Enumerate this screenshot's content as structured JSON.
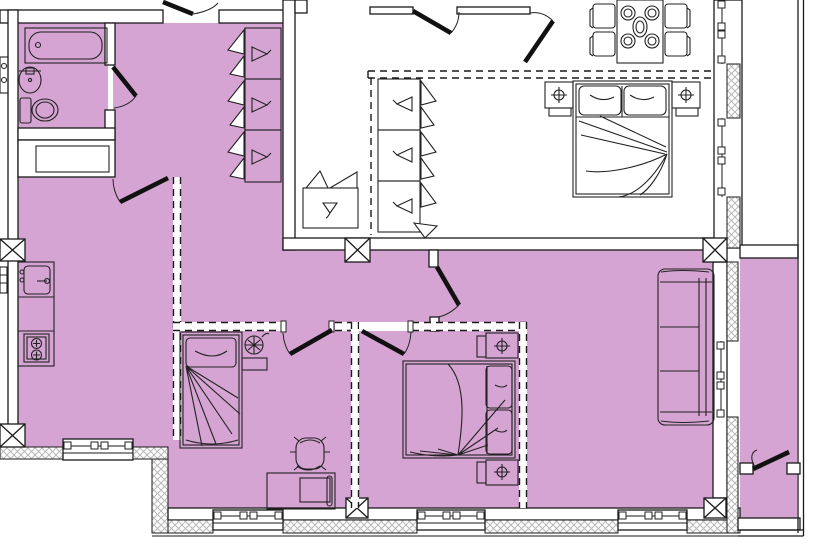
{
  "title": "apartment-floor-plan-with-highlighted-unit",
  "colors": {
    "floor_highlight": "#d5a4d3",
    "wall": "#ffffff",
    "line": "#1a1a1a",
    "hatch": "#b8b8b8",
    "door": "#111111"
  },
  "rooms": [
    {
      "name": "bathroom",
      "highlighted": true
    },
    {
      "name": "entry-hall",
      "highlighted": true
    },
    {
      "name": "kitchen-living-room",
      "highlighted": true
    },
    {
      "name": "bedroom-left",
      "highlighted": true
    },
    {
      "name": "bedroom-middle",
      "highlighted": true
    },
    {
      "name": "walk-through-closet",
      "highlighted": false
    },
    {
      "name": "bedroom-top-right",
      "highlighted": false
    },
    {
      "name": "loggia-top-right",
      "highlighted": false
    },
    {
      "name": "balcony-right",
      "highlighted": true
    }
  ],
  "furniture": [
    "bathtub",
    "washbasin",
    "toilet",
    "kitchen-sink",
    "cooktop",
    "wardrobe-3-sections-left",
    "wardrobe-3-sections-right",
    "laundry-basket",
    "dining-table-4-chairs",
    "double-bed-top-with-nightstands",
    "sofa-3-seat",
    "single-bed",
    "bedside-plant-stand",
    "desk",
    "office-chair",
    "double-bed-bottom-with-nightstands"
  ],
  "structure": {
    "columns": 6,
    "windows": 7,
    "door_swings": 10,
    "balcony_doors": 1
  }
}
